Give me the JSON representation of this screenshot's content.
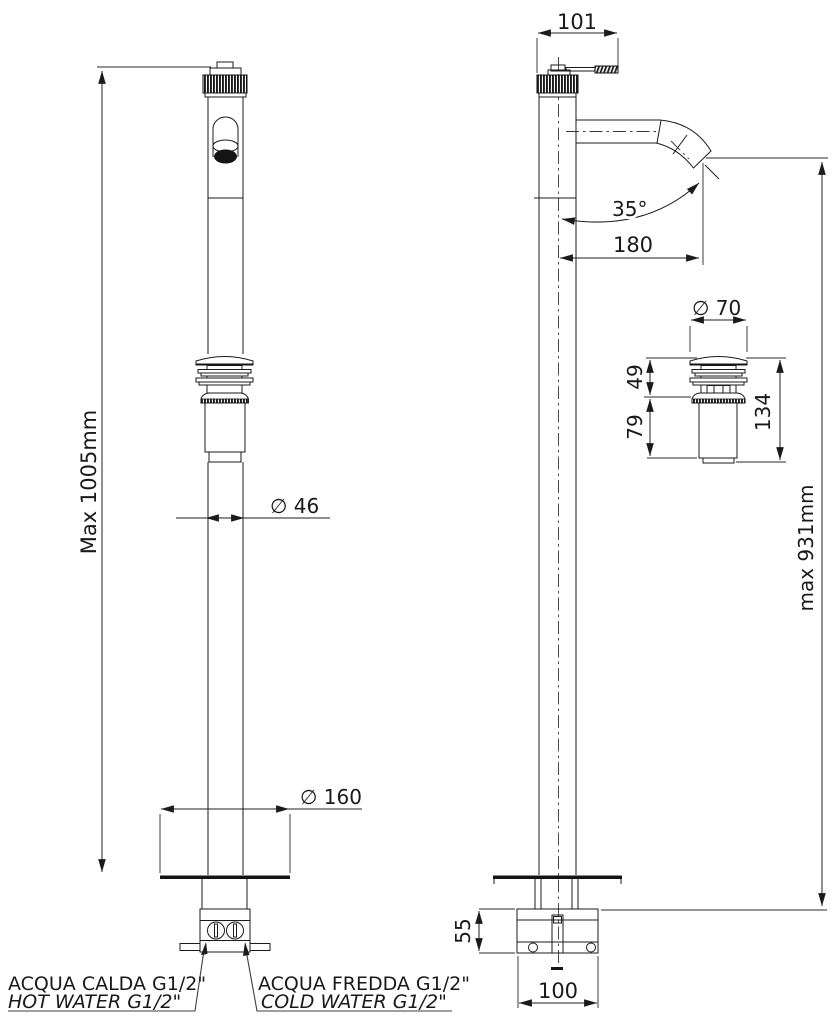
{
  "drawing": {
    "type": "technical-drawing",
    "product": "floor-standing single-lever basin mixer with pop-up waste",
    "views": {
      "front": {
        "height_dim": "Max 1005mm",
        "column_diameter": "∅ 46",
        "base_diameter": "∅ 160"
      },
      "side": {
        "handle_reach": "101",
        "spout_angle": "35°",
        "spout_reach": "180",
        "max_height": "max 931mm",
        "base_height": "55",
        "base_depth": "100"
      },
      "waste_detail": {
        "cap_diameter": "∅ 70",
        "upper_height": "49",
        "lower_height": "79",
        "total_height": "134"
      }
    },
    "connections": {
      "hot": {
        "line1": "ACQUA CALDA G1/2\"",
        "line2": "HOT WATER G1/2\"",
        "color": "#d32220"
      },
      "cold": {
        "line1": "ACQUA FREDDA G1/2\"",
        "line2": "COLD WATER G1/2\"",
        "color": "#2424c9"
      }
    },
    "line_color": "#1b1b1b"
  }
}
